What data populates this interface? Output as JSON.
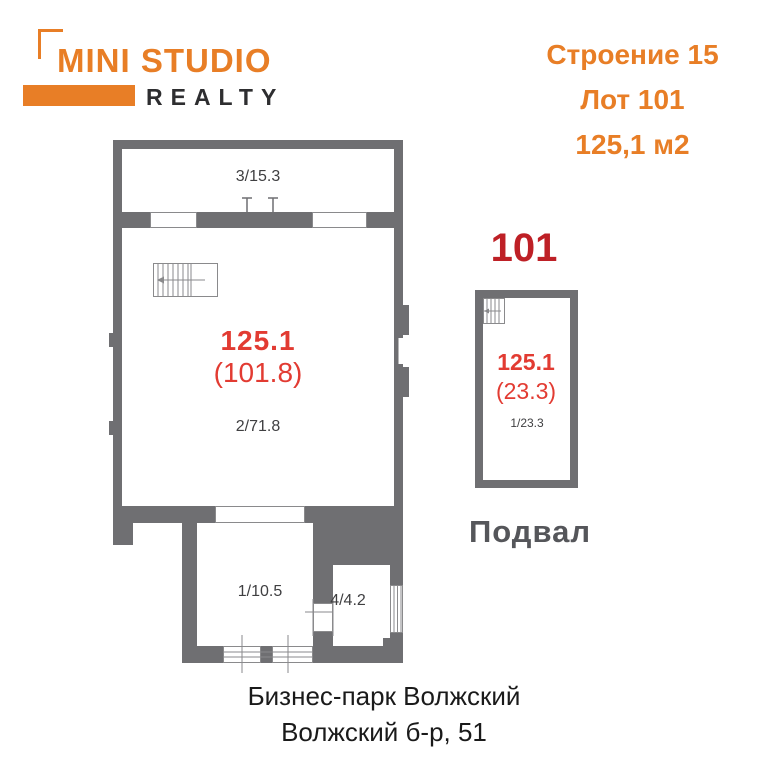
{
  "logo": {
    "primary": "MINI STUDIO",
    "secondary": "REALTY"
  },
  "header": {
    "building": "Строение 15",
    "lot": "Лот 101",
    "area": "125,1 м2"
  },
  "main_plan": {
    "room3_label": "3/15.3",
    "area_total": "125.1",
    "area_detail": "(101.8)",
    "room2_label": "2/71.8",
    "room1_label": "1/10.5",
    "room4_label": "4/4.2"
  },
  "basement_plan": {
    "lot_number": "101",
    "area_total": "125.1",
    "area_detail": "(23.3)",
    "room_label": "1/23.3",
    "caption": "Подвал"
  },
  "footer": {
    "line1": "Бизнес-парк Волжский",
    "line2": "Волжский б-р, 51"
  },
  "colors": {
    "orange": "#E87E26",
    "red": "#E23B32",
    "dark_red": "#BE2026",
    "wall_gray": "#6F6F72",
    "label_gray": "#3F3F41",
    "caption_gray": "#55565A",
    "text_black": "#1A1A1A"
  }
}
